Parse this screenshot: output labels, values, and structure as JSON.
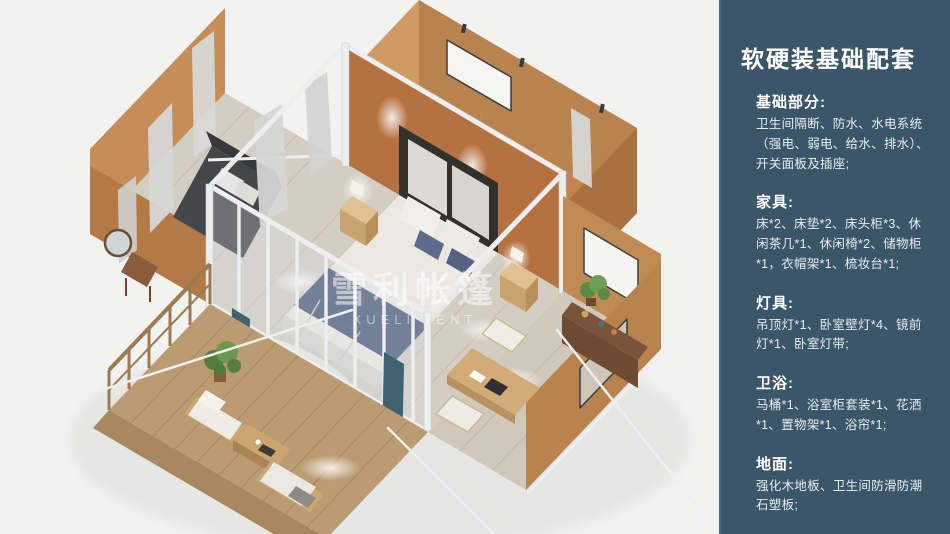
{
  "panel": {
    "title": "软硬装基础配套",
    "background": "#3b5668",
    "text_color": "#ffffff",
    "sections": [
      {
        "heading": "基础部分:",
        "body": "卫生间隔断、防水、水电系统（强电、弱电、给水、排水）、开关面板及插座;"
      },
      {
        "heading": "家具:",
        "body": "床*2、床垫*2、床头柜*3、休闲茶几*1、休闲椅*2、储物柜*1，衣帽架*1、梳妆台*1;"
      },
      {
        "heading": "灯具:",
        "body": "吊顶灯*1、卧室壁灯*4、镜前灯*1、卧室灯带;"
      },
      {
        "heading": "卫浴:",
        "body": "马桶*1、浴室柜套装*1、花洒*1、置物架*1、浴帘*1;"
      },
      {
        "heading": "地面:",
        "body": "强化木地板、卫生间防滑防潮石塑板;"
      }
    ]
  },
  "scene": {
    "type": "3d-isometric-floorplan-render",
    "description": "top-down isometric render of a glamping tent suite: central bedroom, lounge wing, bathroom wing, vanity wing and wooden deck",
    "watermark": {
      "cn": "雪利帐篷",
      "en": "XUELI TENT"
    },
    "palette": {
      "wall": "#bf8452",
      "wall_shadow": "#a9713f",
      "wall_light": "#cf9a63",
      "wall_outer": "#b8834f",
      "floor": "#d4cdc2",
      "deck": "#bb9c72",
      "frame": "#eceef0",
      "bed": "#ece8e1",
      "bed_blue": "#4d5a79",
      "teal": "#3f6170",
      "sofa": "#45464a",
      "plant": "#567f3f",
      "wood_dark": "#6e4c34",
      "wood_desk": "#d2ab77",
      "curtain": "#d6d6d6"
    }
  }
}
